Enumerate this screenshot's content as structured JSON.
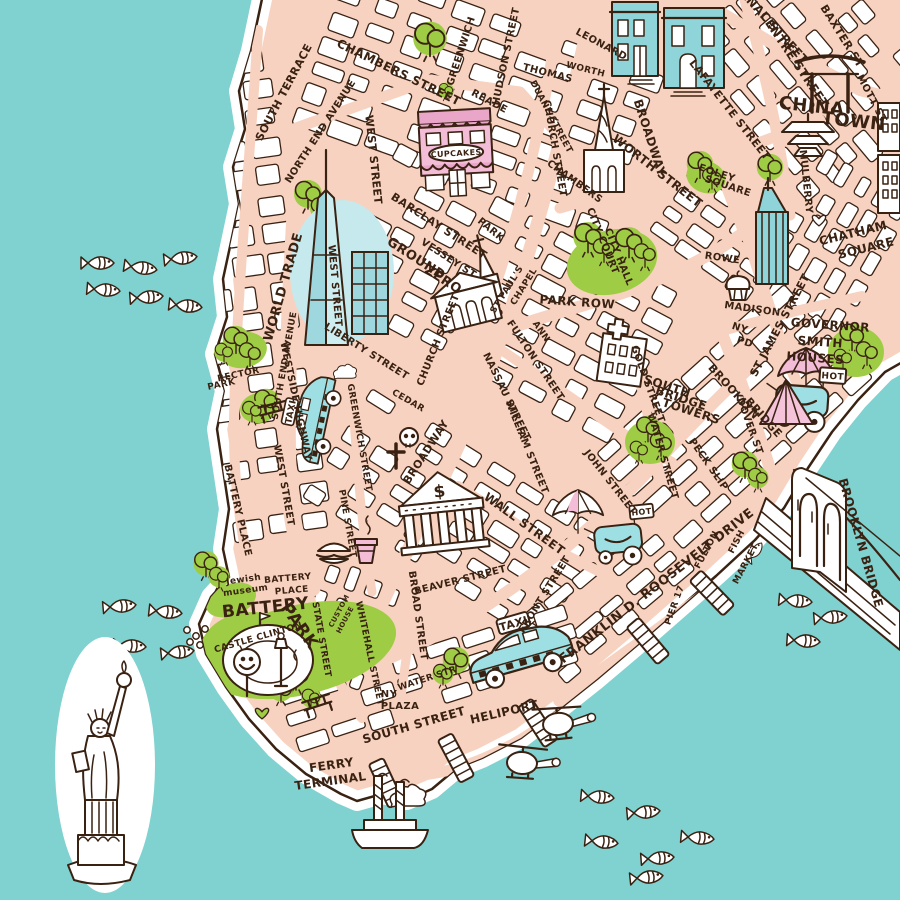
{
  "colors": {
    "water": "#7fd2d0",
    "land": "#f8d2c0",
    "block": "#ffffff",
    "outline": "#3a2213",
    "park_green": "#9fcc45",
    "building_teal": "#8fd4d8",
    "building_pink": "#f3bcd7",
    "taxi_blue": "#9ddfe3",
    "glow_aqua": "#c5e9ec"
  },
  "signs": {
    "cupcakes": "CUPCAKES",
    "taxi": "TAXI",
    "hot": "HOT",
    "dollar": "$"
  },
  "icons": [
    "statue-of-liberty-icon",
    "brooklyn-bridge-icon",
    "ferry-boat-icon",
    "helicopter-icon",
    "taxi-car-icon",
    "hot-dog-cart-icon",
    "umbrella-icon",
    "tree-icon",
    "fish-icon",
    "pier-icon",
    "church-icon",
    "hospital-cross-icon",
    "stock-exchange-icon",
    "skull-icon",
    "grave-cross-icon",
    "hamburger-icon",
    "coffee-cup-icon",
    "muffin-icon",
    "tent-icon",
    "heart-icon",
    "bench-icon",
    "street-lamp-icon",
    "smiley-sculpture-icon",
    "cloud-icon",
    "pagoda-icon",
    "townhouse-icon",
    "skyscraper-icon",
    "castle-clinton-icon"
  ],
  "map_labels": [
    {
      "t": "CANAL STREET",
      "x": 768,
      "y": 26,
      "r": 48,
      "s": 12
    },
    {
      "t": "CENTRE STREET",
      "x": 791,
      "y": 62,
      "r": 56,
      "s": 12
    },
    {
      "t": "BAXTER ST",
      "x": 839,
      "y": 38,
      "r": 58,
      "s": 11
    },
    {
      "t": "LAFAYETTE STREET",
      "x": 727,
      "y": 112,
      "r": 52,
      "s": 11
    },
    {
      "t": "MOTT ST",
      "x": 869,
      "y": 100,
      "r": 62,
      "s": 10
    },
    {
      "t": "MULBERRY",
      "x": 803,
      "y": 182,
      "r": 84,
      "s": 10
    },
    {
      "t": "CHINA",
      "x": 811,
      "y": 112,
      "r": 6,
      "s": 18
    },
    {
      "t": "TOWN",
      "x": 853,
      "y": 127,
      "r": 6,
      "s": 18
    },
    {
      "t": "FOLEY",
      "x": 716,
      "y": 176,
      "r": 18,
      "s": 10
    },
    {
      "t": "SQUARE",
      "x": 727,
      "y": 189,
      "r": 18,
      "s": 10
    },
    {
      "t": "CHATHAM",
      "x": 854,
      "y": 237,
      "r": -14,
      "s": 12
    },
    {
      "t": "SQUARE",
      "x": 867,
      "y": 252,
      "r": -14,
      "s": 12
    },
    {
      "t": "SOUTH TERRACE",
      "x": 287,
      "y": 94,
      "r": -62,
      "s": 11
    },
    {
      "t": "NORTH END AVENUE",
      "x": 323,
      "y": 133,
      "r": -57,
      "s": 10
    },
    {
      "t": "CHAMBERS STREET",
      "x": 397,
      "y": 76,
      "r": 26,
      "s": 12
    },
    {
      "t": "GREENWICH",
      "x": 464,
      "y": 52,
      "r": -72,
      "s": 10
    },
    {
      "t": "HUDSON STREET",
      "x": 509,
      "y": 57,
      "r": -78,
      "s": 10
    },
    {
      "t": "READE",
      "x": 488,
      "y": 104,
      "r": 28,
      "s": 10
    },
    {
      "t": "THOMAS",
      "x": 547,
      "y": 76,
      "r": 14,
      "s": 10
    },
    {
      "t": "WORTH",
      "x": 585,
      "y": 72,
      "r": 14,
      "s": 9
    },
    {
      "t": "DUANE STREET",
      "x": 549,
      "y": 118,
      "r": 62,
      "s": 9
    },
    {
      "t": "CHURCH STREET",
      "x": 552,
      "y": 149,
      "r": 80,
      "s": 10
    },
    {
      "t": "LEONARD",
      "x": 600,
      "y": 47,
      "r": 28,
      "s": 10
    },
    {
      "t": "BROADWAY",
      "x": 646,
      "y": 139,
      "r": 72,
      "s": 12
    },
    {
      "t": "WORTH STREET",
      "x": 655,
      "y": 174,
      "r": 38,
      "s": 12
    },
    {
      "t": "CHAMBERS",
      "x": 573,
      "y": 184,
      "r": 36,
      "s": 10
    },
    {
      "t": "WEST STREET",
      "x": 370,
      "y": 160,
      "r": 84,
      "s": 11
    },
    {
      "t": "BARCLAY STREET",
      "x": 437,
      "y": 229,
      "r": 33,
      "s": 11
    },
    {
      "t": "VESSEY ST",
      "x": 447,
      "y": 261,
      "r": 33,
      "s": 10
    },
    {
      "t": "PARK",
      "x": 489,
      "y": 232,
      "r": 40,
      "s": 10
    },
    {
      "t": "GROUND",
      "x": 414,
      "y": 262,
      "r": 33,
      "s": 13
    },
    {
      "t": "ZERO",
      "x": 441,
      "y": 283,
      "r": 33,
      "s": 13
    },
    {
      "t": "WORLD TRADE",
      "x": 287,
      "y": 288,
      "r": -74,
      "s": 13
    },
    {
      "t": "WEST STREET",
      "x": 332,
      "y": 286,
      "r": 85,
      "s": 10
    },
    {
      "t": "LIBERTY STREET",
      "x": 365,
      "y": 354,
      "r": 32,
      "s": 10
    },
    {
      "t": "CEDAR",
      "x": 407,
      "y": 403,
      "r": 30,
      "s": 9
    },
    {
      "t": "CHURCH STREET",
      "x": 441,
      "y": 341,
      "r": -68,
      "s": 10
    },
    {
      "t": "ST PAUL'S",
      "x": 509,
      "y": 291,
      "r": -58,
      "s": 9
    },
    {
      "t": "CHAPEL",
      "x": 526,
      "y": 288,
      "r": -58,
      "s": 9
    },
    {
      "t": "PARK ROW",
      "x": 577,
      "y": 306,
      "r": 4,
      "s": 12
    },
    {
      "t": "CITY COURT",
      "x": 600,
      "y": 242,
      "r": 68,
      "s": 10
    },
    {
      "t": "CITY HALL",
      "x": 616,
      "y": 258,
      "r": 68,
      "s": 10
    },
    {
      "t": "ANN",
      "x": 539,
      "y": 333,
      "r": 55,
      "s": 9
    },
    {
      "t": "FULTON STREET",
      "x": 533,
      "y": 362,
      "r": 56,
      "s": 10
    },
    {
      "t": "NASSAU STREET",
      "x": 504,
      "y": 398,
      "r": 64,
      "s": 10
    },
    {
      "t": "WILLIAM STREET",
      "x": 524,
      "y": 448,
      "r": 68,
      "s": 10
    },
    {
      "t": "JOHN STREET",
      "x": 608,
      "y": 484,
      "r": 52,
      "s": 10
    },
    {
      "t": "GOLD STREET",
      "x": 645,
      "y": 385,
      "r": 70,
      "s": 10
    },
    {
      "t": "SOUTH",
      "x": 666,
      "y": 390,
      "r": 18,
      "s": 12
    },
    {
      "t": "BRIDGE",
      "x": 680,
      "y": 402,
      "r": 18,
      "s": 12
    },
    {
      "t": "TOWERS",
      "x": 690,
      "y": 415,
      "r": 18,
      "s": 12
    },
    {
      "t": "WATER STREET",
      "x": 660,
      "y": 457,
      "r": 74,
      "s": 10
    },
    {
      "t": "PECK SLIP",
      "x": 706,
      "y": 466,
      "r": 55,
      "s": 10
    },
    {
      "t": "DOVER ST",
      "x": 747,
      "y": 427,
      "r": 70,
      "s": 10
    },
    {
      "t": "BROOKLYN",
      "x": 731,
      "y": 394,
      "r": 48,
      "s": 11
    },
    {
      "t": "BRIDGE",
      "x": 761,
      "y": 420,
      "r": 48,
      "s": 11
    },
    {
      "t": "ROWE",
      "x": 722,
      "y": 261,
      "r": 8,
      "s": 10
    },
    {
      "t": "MADISON",
      "x": 752,
      "y": 312,
      "r": 8,
      "s": 10
    },
    {
      "t": "NY",
      "x": 739,
      "y": 331,
      "r": 18,
      "s": 10
    },
    {
      "t": "PD",
      "x": 744,
      "y": 345,
      "r": 18,
      "s": 10
    },
    {
      "t": "ST JAMES STREET",
      "x": 783,
      "y": 327,
      "r": -62,
      "s": 11
    },
    {
      "t": "GOVERNOR",
      "x": 830,
      "y": 329,
      "r": 4,
      "s": 12
    },
    {
      "t": "SMITH",
      "x": 820,
      "y": 346,
      "r": 4,
      "s": 12
    },
    {
      "t": "HOUSES",
      "x": 815,
      "y": 362,
      "r": 4,
      "s": 12
    },
    {
      "t": "BROOKLYN BRIDGE",
      "x": 857,
      "y": 544,
      "r": 74,
      "s": 12
    },
    {
      "t": "WESTSIDE HIGHWAY",
      "x": 293,
      "y": 402,
      "r": 78,
      "s": 10
    },
    {
      "t": "WEST STREET",
      "x": 281,
      "y": 486,
      "r": 80,
      "s": 10
    },
    {
      "t": "RECTOR",
      "x": 239,
      "y": 377,
      "r": -12,
      "s": 9
    },
    {
      "t": "PARK",
      "x": 222,
      "y": 387,
      "r": -12,
      "s": 9
    },
    {
      "t": "SOUTH END AVENUE",
      "x": 287,
      "y": 366,
      "r": -80,
      "s": 9
    },
    {
      "t": "BATTERY PLACE",
      "x": 235,
      "y": 511,
      "r": 77,
      "s": 10
    },
    {
      "t": "GREENWICH STREET",
      "x": 357,
      "y": 438,
      "r": 80,
      "s": 9
    },
    {
      "t": "PINE STREET",
      "x": 345,
      "y": 524,
      "r": 80,
      "s": 9
    },
    {
      "t": "BROADWAY",
      "x": 429,
      "y": 454,
      "r": -57,
      "s": 11
    },
    {
      "t": "WALL STREET",
      "x": 522,
      "y": 527,
      "r": 36,
      "s": 12
    },
    {
      "t": "BEAVER STREET",
      "x": 461,
      "y": 583,
      "r": -14,
      "s": 10
    },
    {
      "t": "BROAD STREET",
      "x": 415,
      "y": 616,
      "r": 82,
      "s": 10
    },
    {
      "t": "FRONT STREET",
      "x": 547,
      "y": 596,
      "r": -58,
      "s": 10
    },
    {
      "t": "WATER STR",
      "x": 428,
      "y": 681,
      "r": -18,
      "s": 9
    },
    {
      "t": "SOUTH STREET",
      "x": 415,
      "y": 729,
      "r": -16,
      "s": 12
    },
    {
      "t": "FRANKLIN D. ROOSEVELT DRIVE",
      "x": 659,
      "y": 589,
      "r": -38,
      "s": 13
    },
    {
      "t": "FULTON",
      "x": 709,
      "y": 551,
      "r": -62,
      "s": 9
    },
    {
      "t": "FISH",
      "x": 739,
      "y": 543,
      "r": -62,
      "s": 9
    },
    {
      "t": "MARKET",
      "x": 748,
      "y": 565,
      "r": -62,
      "s": 9
    },
    {
      "t": "PIER 17",
      "x": 677,
      "y": 606,
      "r": -70,
      "s": 9
    },
    {
      "t": "HELIPORT",
      "x": 505,
      "y": 716,
      "r": -13,
      "s": 12
    },
    {
      "t": "FERRY",
      "x": 332,
      "y": 769,
      "r": -8,
      "s": 12
    },
    {
      "t": "TERMINAL",
      "x": 331,
      "y": 785,
      "r": -8,
      "s": 12
    },
    {
      "t": "BATTERY",
      "x": 288,
      "y": 581,
      "r": -5,
      "s": 9
    },
    {
      "t": "PLACE",
      "x": 292,
      "y": 593,
      "r": -5,
      "s": 9
    },
    {
      "t": "Jewish",
      "x": 244,
      "y": 582,
      "r": -8,
      "s": 9
    },
    {
      "t": "museum",
      "x": 246,
      "y": 593,
      "r": -8,
      "s": 9
    },
    {
      "t": "BATTERY",
      "x": 266,
      "y": 613,
      "r": -6,
      "s": 17
    },
    {
      "t": "PARK",
      "x": 295,
      "y": 629,
      "r": 55,
      "s": 17
    },
    {
      "t": "CASTLE CLINTON",
      "x": 259,
      "y": 640,
      "r": -16,
      "s": 9
    },
    {
      "t": "STATE STREET",
      "x": 319,
      "y": 640,
      "r": 80,
      "s": 9
    },
    {
      "t": "CUSTOM",
      "x": 341,
      "y": 612,
      "r": -62,
      "s": 7
    },
    {
      "t": "HOUSE",
      "x": 347,
      "y": 621,
      "r": -62,
      "s": 7
    },
    {
      "t": "WHITEHALL STREET",
      "x": 367,
      "y": 654,
      "r": 78,
      "s": 9
    },
    {
      "t": "NY",
      "x": 389,
      "y": 697,
      "r": 0,
      "s": 10
    },
    {
      "t": "PLAZA",
      "x": 400,
      "y": 709,
      "r": 0,
      "s": 10
    }
  ]
}
